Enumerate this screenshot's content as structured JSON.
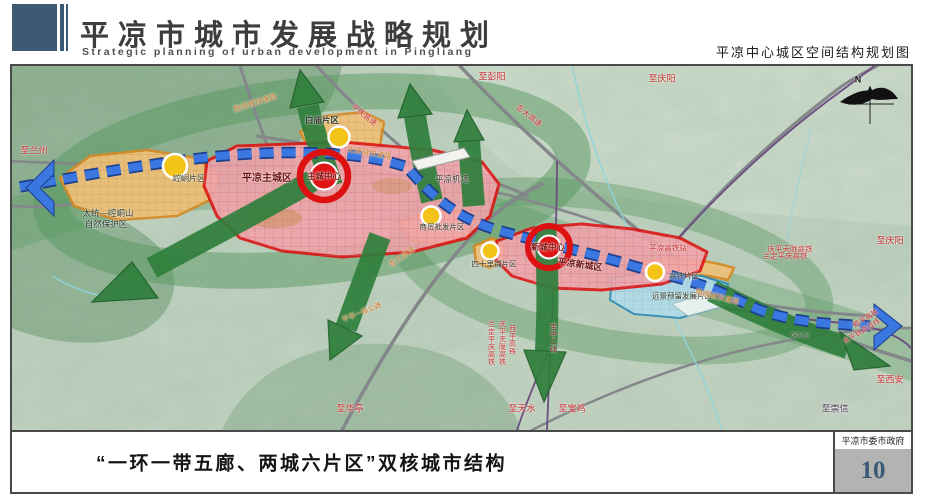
{
  "header": {
    "title": "平凉市城市发展战略规划",
    "subtitle": "Strategic planning of urban development in Pingliang",
    "right_caption": "平凉中心城区空间结构规划图"
  },
  "footer": {
    "caption": "“一环一带五廊、两城六片区”双核城市结构",
    "agency": "平凉市委市政府",
    "page_number": "10"
  },
  "map": {
    "colors": {
      "main_city_border": "#dd1111",
      "district_fill": "#efc079",
      "axis_blue": "#3b77e0",
      "corridor_green": "#2f7f3c",
      "reserve_blue": "#b2dcea"
    },
    "labels": [
      {
        "t": "N",
        "x": 846,
        "y": 14,
        "c": "#111111",
        "s": 9,
        "b": true
      },
      {
        "t": "至兰州",
        "x": 22,
        "y": 85,
        "c": "#c22626",
        "s": 9
      },
      {
        "t": "西绕城快速路",
        "x": 243,
        "y": 37,
        "c": "#c2701d",
        "s": 7.5,
        "r": -18
      },
      {
        "t": "平庆高速",
        "x": 352,
        "y": 49,
        "c": "#c22626",
        "s": 7.5,
        "r": 38
      },
      {
        "t": "白庙片区",
        "x": 310,
        "y": 54,
        "c": "#2c3326",
        "s": 8.5,
        "b": true
      },
      {
        "t": "至彭阳",
        "x": 480,
        "y": 11,
        "c": "#c22626",
        "s": 9
      },
      {
        "t": "彭大高速",
        "x": 517,
        "y": 50,
        "c": "#c22626",
        "s": 7.5,
        "r": 38
      },
      {
        "t": "至庆阳",
        "x": 650,
        "y": 13,
        "c": "#c22626",
        "s": 9
      },
      {
        "t": "北绕城快速路",
        "x": 357,
        "y": 87,
        "c": "#c2701d",
        "s": 7.5,
        "r": 10
      },
      {
        "t": "平凉机场",
        "x": 440,
        "y": 113,
        "c": "#2c3326",
        "s": 8.5
      },
      {
        "t": "主城中心",
        "x": 312,
        "y": 110,
        "c": "#7a0e0e",
        "s": 8.5,
        "b": true
      },
      {
        "t": "平凉主城区",
        "x": 255,
        "y": 113,
        "c": "#6b1010",
        "s": 10,
        "b": true
      },
      {
        "t": "崆峒片区",
        "x": 177,
        "y": 113,
        "c": "#2c3326",
        "s": 8
      },
      {
        "t": "太统—崆峒山",
        "x": 96,
        "y": 147,
        "c": "#25352a",
        "s": 8.5
      },
      {
        "t": "自然保护区",
        "x": 94,
        "y": 158,
        "c": "#25352a",
        "s": 8.5
      },
      {
        "t": "青兰高速",
        "x": 390,
        "y": 191,
        "c": "#c2701d",
        "s": 7.5,
        "r": -35
      },
      {
        "t": "商贸批发片区",
        "x": 430,
        "y": 161,
        "c": "#2c3326",
        "s": 7.5
      },
      {
        "t": "四十里铺片区",
        "x": 482,
        "y": 198,
        "c": "#2c3326",
        "s": 7.5
      },
      {
        "t": "新城中心",
        "x": 536,
        "y": 181,
        "c": "#7a0e0e",
        "s": 8.5,
        "b": true
      },
      {
        "t": "平凉新城区",
        "x": 568,
        "y": 199,
        "c": "#6b1010",
        "s": 9,
        "b": true,
        "r": 8
      },
      {
        "t": "平凉高铁站",
        "x": 656,
        "y": 182,
        "c": "#c22626",
        "s": 7.5
      },
      {
        "t": "庆平天陇高铁",
        "x": 778,
        "y": 183,
        "c": "#c22626",
        "s": 7.5
      },
      {
        "t": "兰定平庆高铁",
        "x": 773,
        "y": 190,
        "c": "#c22626",
        "s": 7.5
      },
      {
        "t": "至庆阳",
        "x": 878,
        "y": 175,
        "c": "#c22626",
        "s": 9
      },
      {
        "t": "高铁片区",
        "x": 672,
        "y": 210,
        "c": "#2c3326",
        "s": 7.5
      },
      {
        "t": "远景预留发展片区",
        "x": 670,
        "y": 230,
        "c": "#2c3326",
        "s": 7.5
      },
      {
        "t": "南绕城快速路",
        "x": 705,
        "y": 231,
        "c": "#c2701d",
        "s": 7.5,
        "r": 14
      },
      {
        "t": "G312",
        "x": 788,
        "y": 269,
        "c": "#2c3326",
        "s": 7.5
      },
      {
        "t": "西平高铁",
        "x": 854,
        "y": 253,
        "c": "#c22626",
        "s": 7,
        "r": -32
      },
      {
        "t": "天平铁路改线",
        "x": 850,
        "y": 266,
        "c": "#c22626",
        "s": 7,
        "r": -32
      },
      {
        "t": "至西安",
        "x": 878,
        "y": 314,
        "c": "#c22626",
        "s": 9
      },
      {
        "t": "至崇信",
        "x": 823,
        "y": 343,
        "c": "#4a3358",
        "s": 9
      },
      {
        "t": "至华亭",
        "x": 338,
        "y": 343,
        "c": "#c22626",
        "s": 9
      },
      {
        "t": "至天水",
        "x": 510,
        "y": 343,
        "c": "#c22626",
        "s": 9
      },
      {
        "t": "至宝鸡",
        "x": 560,
        "y": 343,
        "c": "#c22626",
        "s": 9
      },
      {
        "t": "兰定平庆高铁",
        "x": 479,
        "y": 277,
        "c": "#c22626",
        "s": 7,
        "v": true
      },
      {
        "t": "庆平天陇高铁",
        "x": 490,
        "y": 277,
        "c": "#c22626",
        "s": 7,
        "v": true
      },
      {
        "t": "西平高铁",
        "x": 500,
        "y": 274,
        "c": "#c22626",
        "s": 7,
        "v": true
      },
      {
        "t": "宝中二线",
        "x": 541,
        "y": 272,
        "c": "#7a1515",
        "s": 7,
        "v": true
      },
      {
        "t": "平华一级公路",
        "x": 350,
        "y": 247,
        "c": "#c2701d",
        "s": 7,
        "r": -22
      }
    ]
  }
}
